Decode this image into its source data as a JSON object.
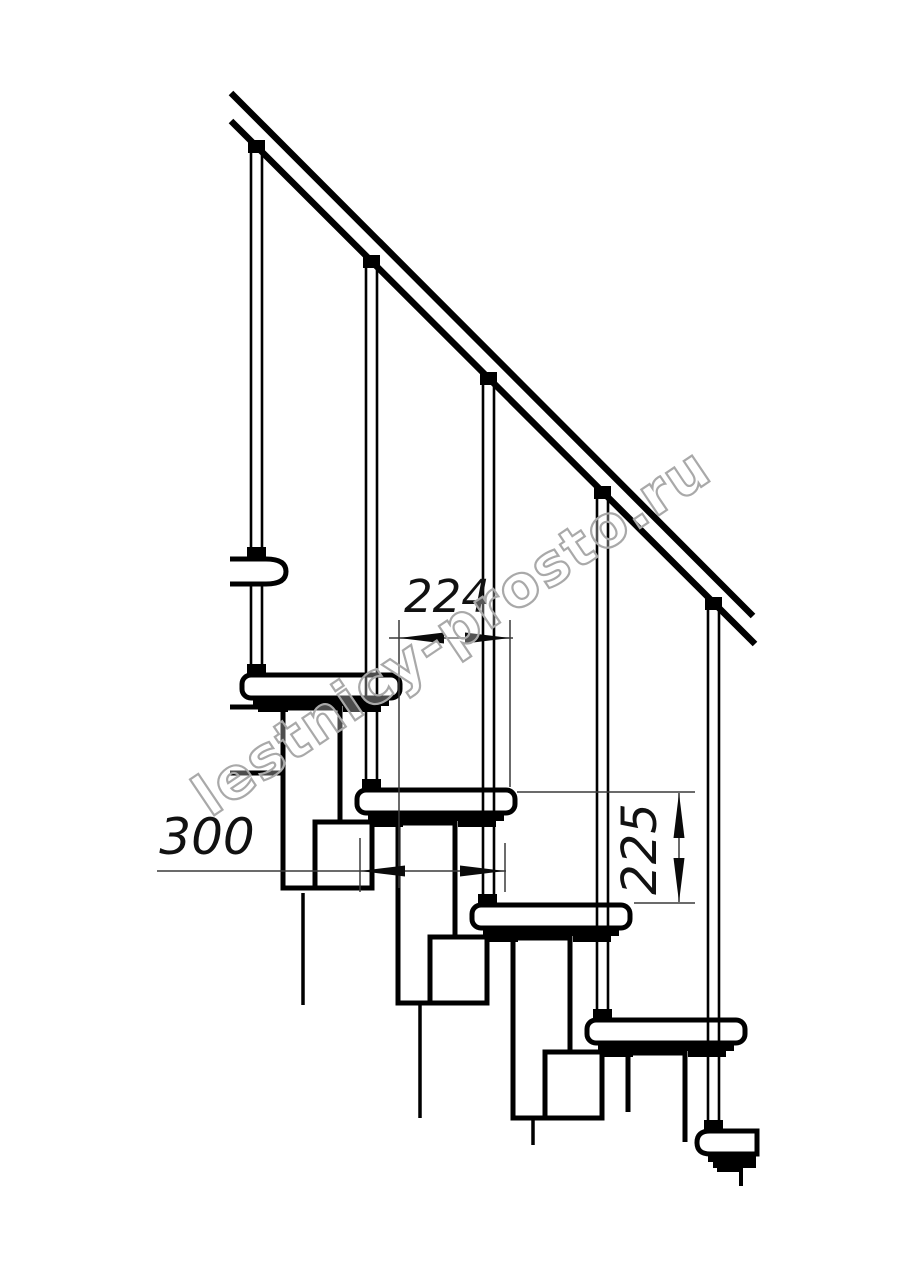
{
  "drawing": {
    "subject": "modular staircase side elevation technical drawing",
    "background_color": "#ffffff",
    "line_color": "#000000",
    "dimension_color": "#3a3a3a",
    "dimensions": {
      "run_horizontal": {
        "value": "224"
      },
      "tread_length": {
        "value": "300"
      },
      "riser_height": {
        "value": "225"
      }
    },
    "watermark": {
      "text": "lestnicy-prosto.ru",
      "outline_color": "#a9a9a9"
    }
  }
}
